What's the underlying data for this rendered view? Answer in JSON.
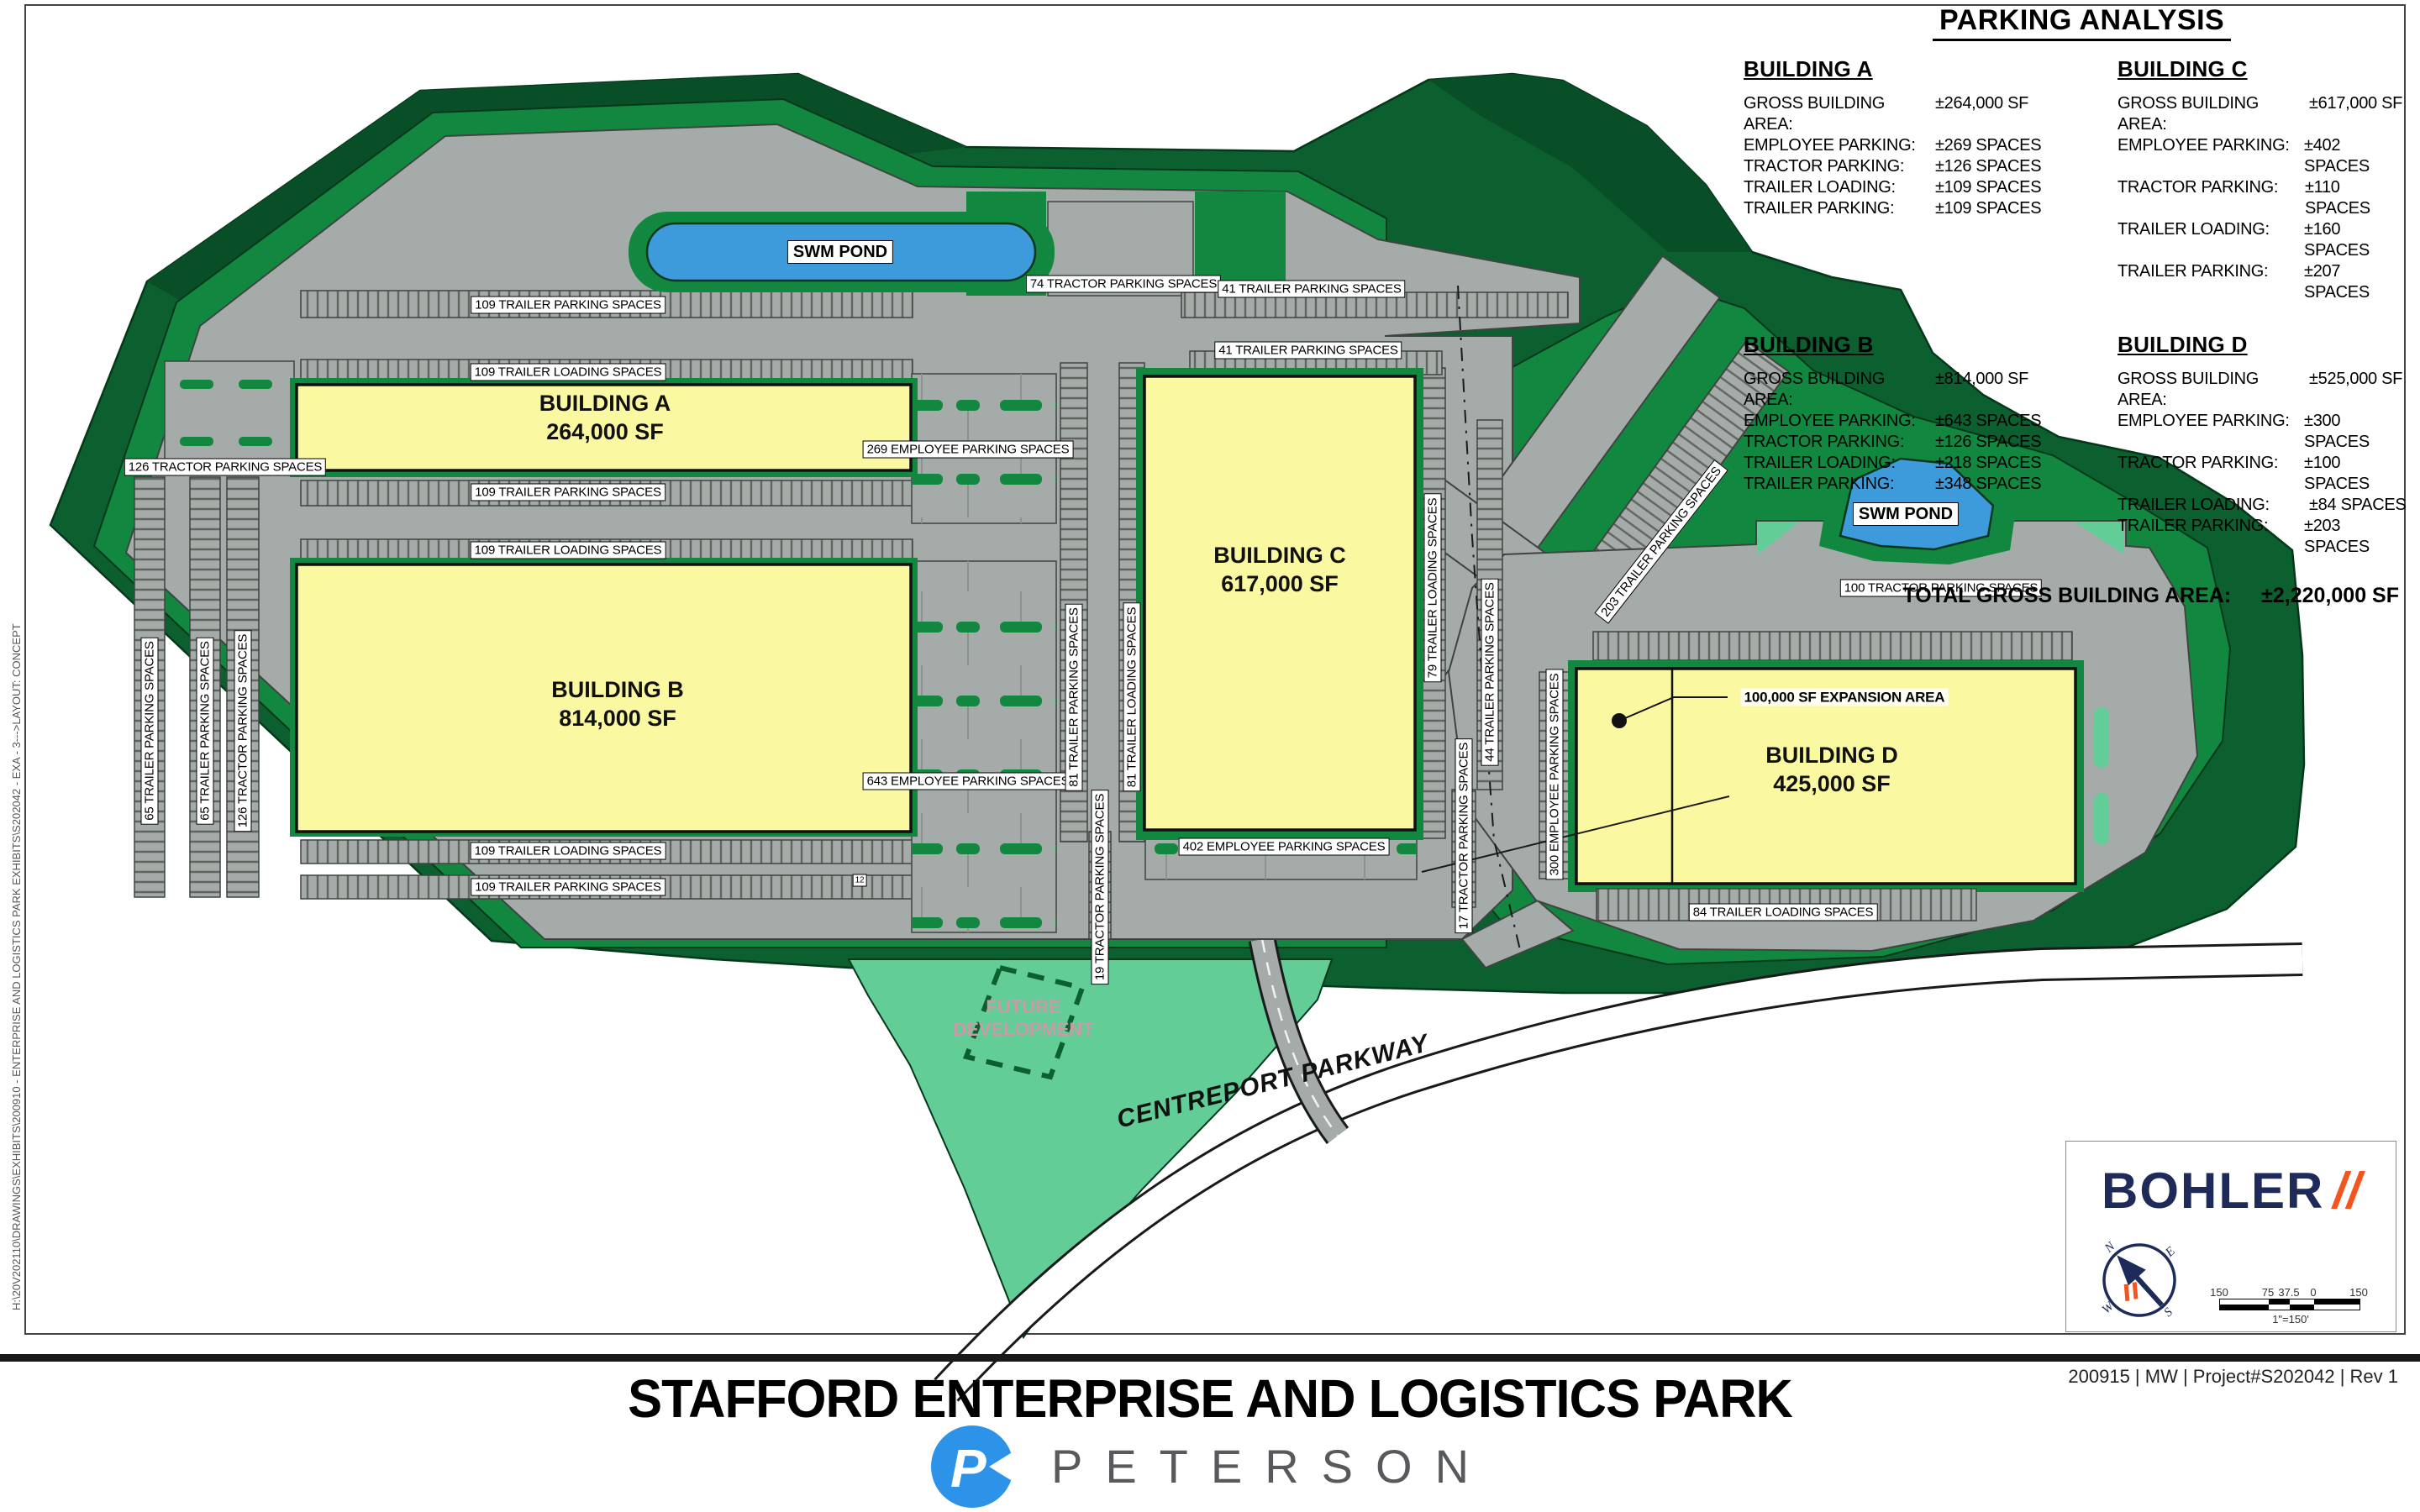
{
  "sheet": {
    "path_note": "H:\\20V202110\\DRAWINGS\\EXHIBITS\\200910 - ENTERPRISE AND LOGISTICS PARK EXHIBITS\\S202042 - EXA - 3--->LAYOUT: CONCEPT",
    "revision_note": "200915 | MW | Project#S202042 | Rev 1"
  },
  "title": "STAFFORD ENTERPRISE AND LOGISTICS PARK",
  "developer_logo": {
    "word": "PETERSON",
    "monogram": "P"
  },
  "engineer_logo": {
    "word": "BOHLER",
    "slashes": "//"
  },
  "compass": {
    "directions": [
      "N",
      "E",
      "S",
      "W"
    ]
  },
  "scale_bar": {
    "ticks": [
      "150",
      "75",
      "37.5",
      "0",
      "150"
    ],
    "scale_text": "1\"=150'"
  },
  "parking_analysis": {
    "title": "PARKING ANALYSIS",
    "total_label": "TOTAL GROSS BUILDING AREA:",
    "total_value": "±2,220,000 SF",
    "buildings": [
      {
        "name": "BUILDING A",
        "rows": [
          [
            "GROSS BUILDING AREA:",
            "±264,000 SF"
          ],
          [
            "EMPLOYEE PARKING:",
            "±269 SPACES"
          ],
          [
            "TRACTOR PARKING:",
            "±126 SPACES"
          ],
          [
            "TRAILER LOADING:",
            "±109 SPACES"
          ],
          [
            "TRAILER PARKING:",
            "±109 SPACES"
          ]
        ]
      },
      {
        "name": "BUILDING B",
        "rows": [
          [
            "GROSS BUILDING AREA:",
            "±814,000 SF"
          ],
          [
            "EMPLOYEE PARKING:",
            "±643 SPACES"
          ],
          [
            "TRACTOR PARKING:",
            "±126 SPACES"
          ],
          [
            "TRAILER LOADING:",
            "±218 SPACES"
          ],
          [
            "TRAILER PARKING:",
            "±348 SPACES"
          ]
        ]
      },
      {
        "name": "BUILDING C",
        "rows": [
          [
            "GROSS BUILDING AREA:",
            "±617,000 SF"
          ],
          [
            "EMPLOYEE PARKING:",
            "±402 SPACES"
          ],
          [
            "TRACTOR PARKING:",
            "±110 SPACES"
          ],
          [
            "TRAILER LOADING:",
            "±160 SPACES"
          ],
          [
            "TRAILER PARKING:",
            "±207 SPACES"
          ]
        ]
      },
      {
        "name": "BUILDING D",
        "rows": [
          [
            "GROSS BUILDING AREA:",
            "±525,000 SF"
          ],
          [
            "EMPLOYEE PARKING:",
            "±300 SPACES"
          ],
          [
            "TRACTOR PARKING:",
            "±100 SPACES"
          ],
          [
            "TRAILER LOADING:",
            "±84 SPACES"
          ],
          [
            "TRAILER PARKING:",
            "±203 SPACES"
          ]
        ]
      }
    ]
  },
  "plan_buildings": [
    {
      "name": "BUILDING A",
      "area": "264,000 SF"
    },
    {
      "name": "BUILDING B",
      "area": "814,000 SF"
    },
    {
      "name": "BUILDING C",
      "area": "617,000 SF"
    },
    {
      "name": "BUILDING D",
      "area": "425,000 SF"
    }
  ],
  "ponds": [
    "SWM POND",
    "SWM POND"
  ],
  "future_development": [
    "FUTURE",
    "DEVELOPMENT"
  ],
  "road_name": "CENTREPORT PARKWAY",
  "plan_labels": [
    "109 TRAILER PARKING SPACES",
    "109 TRAILER LOADING SPACES",
    "109 TRAILER PARKING SPACES",
    "109 TRAILER LOADING SPACES",
    "109 TRAILER LOADING SPACES",
    "109 TRAILER PARKING SPACES",
    "126 TRACTOR PARKING SPACES",
    "65 TRAILER PARKING SPACES",
    "65 TRAILER PARKING SPACES",
    "126 TRACTOR PARKING SPACES",
    "74 TRACTOR PARKING SPACES",
    "41 TRAILER PARKING SPACES",
    "41 TRAILER PARKING SPACES",
    "269 EMPLOYEE PARKING SPACES",
    "643 EMPLOYEE PARKING SPACES",
    "81 TRAILER PARKING SPACES",
    "81 TRAILER LOADING SPACES",
    "79 TRAILER LOADING SPACES",
    "44 TRAILER PARKING SPACES",
    "19 TRACTOR PARKING SPACES",
    "17 TRACTOR PARKING SPACES",
    "402 EMPLOYEE PARKING SPACES",
    "203 TRAILER PARKING SPACES",
    "100 TRACTOR PARKING SPACES",
    "300 EMPLOYEE PARKING SPACES",
    "84 TRAILER LOADING SPACES",
    "12",
    "100,000 SF EXPANSION AREA"
  ],
  "colors": {
    "dark_green": "#0c5f2e",
    "darker_green": "#084f27",
    "site_green": "#12873f",
    "light_green": "#62cd96",
    "pond_blue": "#3e9bdb",
    "lot_gray": "#a5aba8",
    "building_yellow": "#faf9a1",
    "bohler_navy": "#1e2a59",
    "bohler_orange": "#f4551f",
    "peterson_blue": "#2d93e8"
  }
}
